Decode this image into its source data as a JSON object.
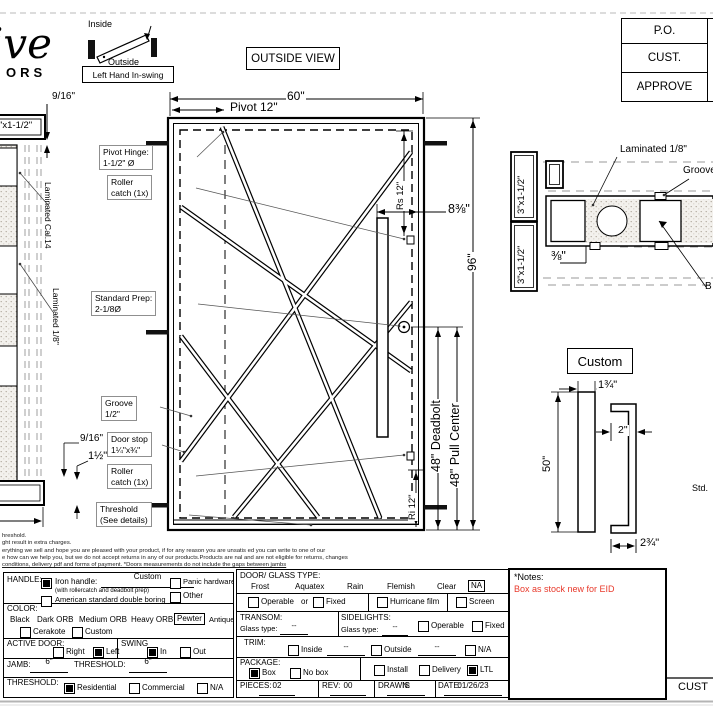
{
  "page": {
    "bg": "#ffffff",
    "ink": "#000000",
    "note_red": "#e8392b"
  },
  "logo": {
    "script": "ive",
    "word": "ORS"
  },
  "swing": {
    "inside": "Inside",
    "outside": "Outside",
    "caption": "Left Hand In-swing"
  },
  "view_label": "OUTSIDE VIEW",
  "approval": {
    "rows": [
      "P.O.",
      "CUST.",
      "APPROVE"
    ]
  },
  "side_view": {
    "tube": "\"x1-1/2\"",
    "dim_top": "9/16\"",
    "lam_a": "Laminated Cal.14",
    "lam_b": "Laminated 1/8\"",
    "dim_b1": "9/16\"",
    "dim_b2": "1½\""
  },
  "elevation": {
    "dim_width": "60\"",
    "dim_pivot": "Pivot 12\"",
    "dim_height": "96\"",
    "dim_offset": "8⅜\"",
    "dim_rs": "Rs 12\"",
    "dim_ri": "Ri 12\"",
    "dim_deadbolt": "48\" Deadbolt",
    "dim_pull": "48\" Pull Center",
    "callouts": {
      "pivot1": "Pivot Hinge:",
      "pivot2": "1-1/2\" Ø",
      "roller1": "Roller",
      "roller2": "catch (1x)",
      "prep1": "Standard Prep:",
      "prep2": "2-1/8Ø",
      "groove1": "Groove",
      "groove2": "1/2\"",
      "stop1": "Door stop",
      "stop2": "1¼\"x¾\"",
      "rollerb1": "Roller",
      "rollerb2": "catch (1x)",
      "thresh1": "Threshold",
      "thresh2": "(See details)"
    }
  },
  "section": {
    "tube1": "3\"x1-1/2\"",
    "tube2": "3\"x1-1/2\"",
    "laminated": "Laminated 1/8\"",
    "groove": "Groove",
    "dim": "⅜\"",
    "cut": "B"
  },
  "handle_detail": {
    "title": "Custom",
    "dim_h": "50\"",
    "dim_w": "1¾\"",
    "dim_d": "2\"",
    "dim_b": "2¾\"",
    "std": "Std."
  },
  "disclaimer": {
    "l1": "hreshold.",
    "l2": "ght result in extra charges.",
    "l3": "erything we sell and hope you are pleased with your product, if for any reason you are unsatis  ed you can write to one of our",
    "l4": "e how can we help you, but we do not accept returns in any of our products.Products are   nal and are not eligible for returns, changes",
    "l5": "conditions, delivery pdf and forms of payment. *Doors measurements do not include the gaps between jambs"
  },
  "form": {
    "handle": {
      "label": "HANDLE:",
      "iron": "Iron handle:",
      "iron_value": "Custom",
      "note": "(with rollercatch and deadbolt prep)",
      "boring": "American standard double boring",
      "panic": "Panic hardware",
      "other": "Other"
    },
    "color": {
      "label": "COLOR:",
      "options": [
        "Black",
        "Dark ORB",
        "Medium ORB",
        "Heavy ORB",
        "Pewter",
        "Antique gold"
      ],
      "cerakote": "Cerakote",
      "custom": "Custom"
    },
    "active": {
      "label": "ACTIVE DOOR:",
      "right": "Right",
      "left": "Left",
      "swing": "SWING",
      "in": "In",
      "out": "Out"
    },
    "jamb": {
      "label": "JAMB:",
      "value": "6\"",
      "t_label": "THRESHOLD:",
      "t_value": "6\""
    },
    "threshold": {
      "label": "THRESHOLD:",
      "residential": "Residential",
      "commercial": "Commercial",
      "na": "N/A"
    },
    "glass": {
      "label": "DOOR/ GLASS TYPE:",
      "options": [
        "Frost",
        "Aquatex",
        "Rain",
        "Flemish",
        "Clear",
        "NA"
      ],
      "operable": "Operable",
      "or": "or",
      "fixed": "Fixed",
      "hurricane": "Hurricane film",
      "screen": "Screen"
    },
    "transom": {
      "label": "TRANSOM:",
      "glass_type": "Glass type:",
      "value": "--"
    },
    "sidelights": {
      "label": "SIDELIGHTS:",
      "glass_type": "Glass type:",
      "value": "--",
      "operable": "Operable",
      "fixed": "Fixed"
    },
    "trim": {
      "label": "TRIM:",
      "inside": "Inside",
      "outside": "Outside",
      "na": "N/A",
      "value": "--"
    },
    "package": {
      "label": "PACKAGE:",
      "box": "Box",
      "no_box": "No box",
      "install": "Install",
      "delivery": "Delivery",
      "ltl": "LTL"
    },
    "footer": {
      "pieces_label": "PIECES:",
      "pieces": "02",
      "rev_label": "REV:",
      "rev": "00",
      "drawn_label": "DRAWN:",
      "drawn": "IS",
      "date_label": "DATE:",
      "date": "01/26/23"
    },
    "checks": {
      "iron": true,
      "boring": false,
      "panic": false,
      "other": false,
      "cerakote": false,
      "custom_color": false,
      "right": false,
      "left": true,
      "swing_in": true,
      "swing_out": false,
      "residential": true,
      "commercial": false,
      "thresh_na": false,
      "operable": false,
      "fixed": false,
      "hurricane": false,
      "screen": false,
      "sl_operable": false,
      "sl_fixed": false,
      "trim_inside": false,
      "trim_outside": false,
      "trim_na": false,
      "box": true,
      "no_box": false,
      "install": false,
      "delivery": false,
      "ltl": true
    }
  },
  "notes": {
    "title": "*Notes:",
    "body": "Box as stock new for EID"
  },
  "signature": "CUST"
}
